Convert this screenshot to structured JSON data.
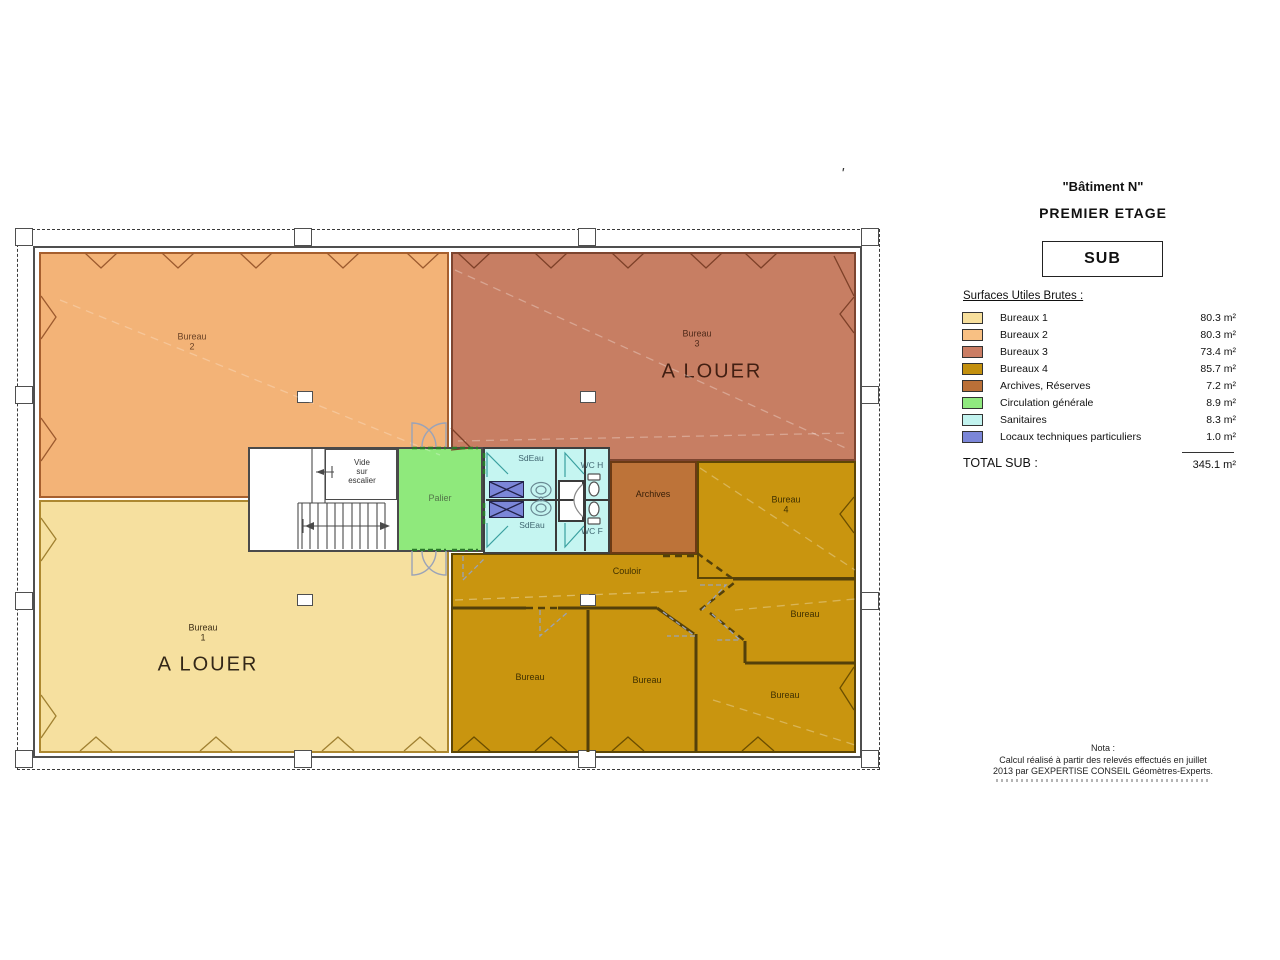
{
  "panel": {
    "building_title": "\"Bâtiment N\"",
    "floor_title": "PREMIER ETAGE",
    "sub_label": "SUB",
    "legend_header": "Surfaces Utiles Brutes :",
    "legend_items": [
      {
        "label": "Bureaux 1",
        "value": "80.3 m²",
        "color": "#F7DF9C"
      },
      {
        "label": "Bureaux 2",
        "value": "80.3 m²",
        "color": "#F8C083"
      },
      {
        "label": "Bureaux 3",
        "value": "73.4 m²",
        "color": "#CA7D64"
      },
      {
        "label": "Bureaux 4",
        "value": "85.7 m²",
        "color": "#C3900E"
      },
      {
        "label": "Archives, Réserves",
        "value": "7.2 m²",
        "color": "#BA7038"
      },
      {
        "label": "Circulation générale",
        "value": "8.9 m²",
        "color": "#90E97F"
      },
      {
        "label": "Sanitaires",
        "value": "8.3 m²",
        "color": "#C2F3EF"
      },
      {
        "label": "Locaux techniques particuliers",
        "value": "1.0 m²",
        "color": "#7B86D8"
      }
    ],
    "total_label": "TOTAL SUB :",
    "total_value": "345.1 m²",
    "nota": {
      "line1": "Nota :",
      "line2": "Calcul réalisé à partir des relevés effectués en juillet",
      "line3": "2013 par GEXPERTISE CONSEIL Géomètres-Experts."
    }
  },
  "plan": {
    "tick_mark": "'",
    "rooms": {
      "bureau1": {
        "name": "Bureau",
        "number": "1",
        "status": "A LOUER"
      },
      "bureau2": {
        "name": "Bureau",
        "number": "2"
      },
      "bureau3": {
        "name": "Bureau",
        "number": "3",
        "status": "A LOUER"
      },
      "bureau4": {
        "name": "Bureau",
        "number": "4"
      },
      "archives": "Archives",
      "couloir": "Couloir",
      "bureau_generic": "Bureau",
      "palier": "Palier",
      "sdeau": "SdEau",
      "wc_h": "WC H",
      "wc_f": "WC F",
      "vide": {
        "line1": "Vide",
        "line2": "sur",
        "line3": "escalier"
      }
    },
    "colors": {
      "bureau1": "#F6E09F",
      "bureau2": "#F3B377",
      "bureau3": "#C77E63",
      "bureau4": "#C9950F",
      "gold": "#C9950F",
      "archives": "#BD7339",
      "circulation": "#8FE97C",
      "sanitaires": "#C5F5F1",
      "locaux": "#7B86D8"
    }
  }
}
